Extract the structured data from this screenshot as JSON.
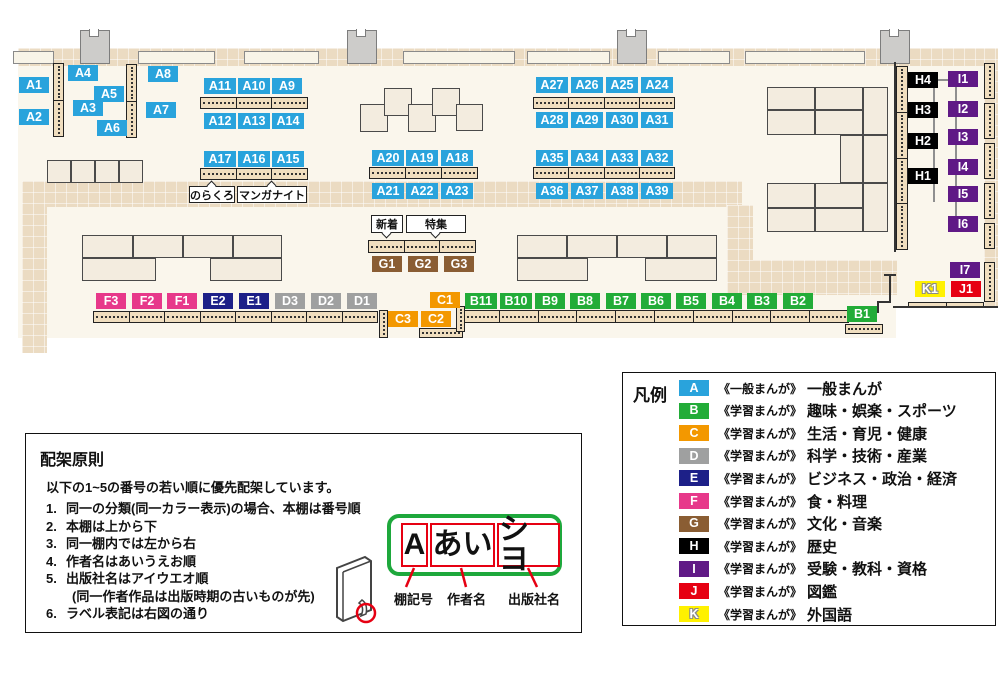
{
  "colors": {
    "A": "#29A3DC",
    "B": "#22AC38",
    "C": "#F39800",
    "D": "#9FA0A0",
    "E": "#1D2088",
    "F": "#E7388A",
    "G": "#8A5D33",
    "H": "#000000",
    "I": "#601986",
    "J": "#E60012",
    "K": "#FFF100"
  },
  "map": {
    "labels": [
      {
        "t": "A1",
        "c": "A",
        "x": 19,
        "y": 77
      },
      {
        "t": "A2",
        "c": "A",
        "x": 19,
        "y": 109
      },
      {
        "t": "A4",
        "c": "A",
        "x": 68,
        "y": 65
      },
      {
        "t": "A5",
        "c": "A",
        "x": 94,
        "y": 86
      },
      {
        "t": "A3",
        "c": "A",
        "x": 73,
        "y": 100
      },
      {
        "t": "A6",
        "c": "A",
        "x": 97,
        "y": 120
      },
      {
        "t": "A8",
        "c": "A",
        "x": 148,
        "y": 66
      },
      {
        "t": "A7",
        "c": "A",
        "x": 146,
        "y": 102
      },
      {
        "t": "A11",
        "c": "A",
        "x": 204,
        "y": 78
      },
      {
        "t": "A10",
        "c": "A",
        "x": 238,
        "y": 78
      },
      {
        "t": "A9",
        "c": "A",
        "x": 272,
        "y": 78
      },
      {
        "t": "A12",
        "c": "A",
        "x": 204,
        "y": 113
      },
      {
        "t": "A13",
        "c": "A",
        "x": 238,
        "y": 113
      },
      {
        "t": "A14",
        "c": "A",
        "x": 272,
        "y": 113
      },
      {
        "t": "A17",
        "c": "A",
        "x": 204,
        "y": 151
      },
      {
        "t": "A16",
        "c": "A",
        "x": 238,
        "y": 151
      },
      {
        "t": "A15",
        "c": "A",
        "x": 272,
        "y": 151
      },
      {
        "t": "A20",
        "c": "A",
        "x": 372,
        "y": 150
      },
      {
        "t": "A19",
        "c": "A",
        "x": 406,
        "y": 150
      },
      {
        "t": "A18",
        "c": "A",
        "x": 441,
        "y": 150
      },
      {
        "t": "A21",
        "c": "A",
        "x": 372,
        "y": 183
      },
      {
        "t": "A22",
        "c": "A",
        "x": 406,
        "y": 183
      },
      {
        "t": "A23",
        "c": "A",
        "x": 441,
        "y": 183
      },
      {
        "t": "A27",
        "c": "A",
        "x": 536,
        "y": 77
      },
      {
        "t": "A26",
        "c": "A",
        "x": 571,
        "y": 77
      },
      {
        "t": "A25",
        "c": "A",
        "x": 606,
        "y": 77
      },
      {
        "t": "A24",
        "c": "A",
        "x": 641,
        "y": 77
      },
      {
        "t": "A28",
        "c": "A",
        "x": 536,
        "y": 112
      },
      {
        "t": "A29",
        "c": "A",
        "x": 571,
        "y": 112
      },
      {
        "t": "A30",
        "c": "A",
        "x": 606,
        "y": 112
      },
      {
        "t": "A31",
        "c": "A",
        "x": 641,
        "y": 112
      },
      {
        "t": "A35",
        "c": "A",
        "x": 536,
        "y": 150
      },
      {
        "t": "A34",
        "c": "A",
        "x": 571,
        "y": 150
      },
      {
        "t": "A33",
        "c": "A",
        "x": 606,
        "y": 150
      },
      {
        "t": "A32",
        "c": "A",
        "x": 641,
        "y": 150
      },
      {
        "t": "A36",
        "c": "A",
        "x": 536,
        "y": 183
      },
      {
        "t": "A37",
        "c": "A",
        "x": 571,
        "y": 183
      },
      {
        "t": "A38",
        "c": "A",
        "x": 606,
        "y": 183
      },
      {
        "t": "A39",
        "c": "A",
        "x": 641,
        "y": 183
      },
      {
        "t": "G1",
        "c": "G",
        "x": 372,
        "y": 256
      },
      {
        "t": "G2",
        "c": "G",
        "x": 408,
        "y": 256
      },
      {
        "t": "G3",
        "c": "G",
        "x": 444,
        "y": 256
      },
      {
        "t": "F3",
        "c": "F",
        "x": 96,
        "y": 293
      },
      {
        "t": "F2",
        "c": "F",
        "x": 132,
        "y": 293
      },
      {
        "t": "F1",
        "c": "F",
        "x": 167,
        "y": 293
      },
      {
        "t": "E2",
        "c": "E",
        "x": 203,
        "y": 293
      },
      {
        "t": "E1",
        "c": "E",
        "x": 239,
        "y": 293
      },
      {
        "t": "D3",
        "c": "D",
        "x": 275,
        "y": 293
      },
      {
        "t": "D2",
        "c": "D",
        "x": 311,
        "y": 293
      },
      {
        "t": "D1",
        "c": "D",
        "x": 347,
        "y": 293
      },
      {
        "t": "C1",
        "c": "C",
        "x": 430,
        "y": 292
      },
      {
        "t": "C3",
        "c": "C",
        "x": 388,
        "y": 311
      },
      {
        "t": "C2",
        "c": "C",
        "x": 421,
        "y": 311
      },
      {
        "t": "B11",
        "c": "B",
        "x": 465,
        "y": 293
      },
      {
        "t": "B10",
        "c": "B",
        "x": 500,
        "y": 293
      },
      {
        "t": "B9",
        "c": "B",
        "x": 535,
        "y": 293
      },
      {
        "t": "B8",
        "c": "B",
        "x": 570,
        "y": 293
      },
      {
        "t": "B7",
        "c": "B",
        "x": 606,
        "y": 293
      },
      {
        "t": "B6",
        "c": "B",
        "x": 641,
        "y": 293
      },
      {
        "t": "B5",
        "c": "B",
        "x": 676,
        "y": 293
      },
      {
        "t": "B4",
        "c": "B",
        "x": 712,
        "y": 293
      },
      {
        "t": "B3",
        "c": "B",
        "x": 747,
        "y": 293
      },
      {
        "t": "B2",
        "c": "B",
        "x": 783,
        "y": 293
      },
      {
        "t": "B1",
        "c": "B",
        "x": 847,
        "y": 306
      },
      {
        "t": "H4",
        "c": "H",
        "x": 908,
        "y": 72
      },
      {
        "t": "H3",
        "c": "H",
        "x": 908,
        "y": 102
      },
      {
        "t": "H2",
        "c": "H",
        "x": 908,
        "y": 133
      },
      {
        "t": "H1",
        "c": "H",
        "x": 908,
        "y": 168
      },
      {
        "t": "I1",
        "c": "I",
        "x": 948,
        "y": 71
      },
      {
        "t": "I2",
        "c": "I",
        "x": 948,
        "y": 101
      },
      {
        "t": "I3",
        "c": "I",
        "x": 948,
        "y": 129
      },
      {
        "t": "I4",
        "c": "I",
        "x": 948,
        "y": 159
      },
      {
        "t": "I5",
        "c": "I",
        "x": 948,
        "y": 186
      },
      {
        "t": "I6",
        "c": "I",
        "x": 948,
        "y": 216
      },
      {
        "t": "I7",
        "c": "I",
        "x": 950,
        "y": 262
      },
      {
        "t": "K1",
        "c": "K",
        "x": 915,
        "y": 281
      },
      {
        "t": "J1",
        "c": "J",
        "x": 951,
        "y": 281
      }
    ],
    "notes": [
      {
        "t": "のらくろ",
        "x": 189,
        "y": 186,
        "w": 46,
        "h": 17,
        "tail": "top"
      },
      {
        "t": "マンガナイト",
        "x": 237,
        "y": 186,
        "w": 70,
        "h": 17,
        "tail": "top"
      },
      {
        "t": "新着",
        "x": 371,
        "y": 215,
        "w": 32,
        "h": 18,
        "tail": "bottom"
      },
      {
        "t": "特集",
        "x": 406,
        "y": 215,
        "w": 60,
        "h": 18,
        "tail": "bottom"
      }
    ],
    "strips": [
      {
        "x": 200,
        "y": 97,
        "w": 108,
        "h": 12,
        "s": 3
      },
      {
        "x": 200,
        "y": 168,
        "w": 108,
        "h": 12,
        "s": 3
      },
      {
        "x": 369,
        "y": 167,
        "w": 109,
        "h": 12,
        "s": 3
      },
      {
        "x": 533,
        "y": 97,
        "w": 142,
        "h": 12,
        "s": 4
      },
      {
        "x": 533,
        "y": 167,
        "w": 142,
        "h": 12,
        "s": 4
      },
      {
        "x": 368,
        "y": 240,
        "w": 108,
        "h": 13,
        "s": 3
      },
      {
        "x": 93,
        "y": 311,
        "w": 285,
        "h": 12,
        "s": 8
      },
      {
        "x": 460,
        "y": 310,
        "w": 389,
        "h": 13,
        "s": 10
      },
      {
        "x": 419,
        "y": 328,
        "w": 44,
        "h": 10,
        "s": 1
      },
      {
        "x": 845,
        "y": 324,
        "w": 38,
        "h": 10,
        "s": 1
      },
      {
        "x": 908,
        "y": 302,
        "w": 76,
        "h": 11,
        "s": 2
      },
      {
        "x": 53,
        "y": 63,
        "w": 11,
        "h": 74,
        "s": 2,
        "v": 1
      },
      {
        "x": 126,
        "y": 64,
        "w": 11,
        "h": 74,
        "s": 2,
        "v": 1
      },
      {
        "x": 896,
        "y": 66,
        "w": 12,
        "h": 184,
        "s": 4,
        "v": 1
      },
      {
        "x": 984,
        "y": 63,
        "w": 11,
        "h": 36,
        "s": 1,
        "v": 1
      },
      {
        "x": 984,
        "y": 103,
        "w": 11,
        "h": 36,
        "s": 1,
        "v": 1
      },
      {
        "x": 984,
        "y": 143,
        "w": 11,
        "h": 36,
        "s": 1,
        "v": 1
      },
      {
        "x": 984,
        "y": 183,
        "w": 11,
        "h": 36,
        "s": 1,
        "v": 1
      },
      {
        "x": 984,
        "y": 223,
        "w": 11,
        "h": 26,
        "s": 1,
        "v": 1
      },
      {
        "x": 984,
        "y": 262,
        "w": 11,
        "h": 40,
        "s": 1,
        "v": 1
      },
      {
        "x": 379,
        "y": 310,
        "w": 9,
        "h": 28,
        "s": 1,
        "v": 1
      },
      {
        "x": 456,
        "y": 306,
        "w": 9,
        "h": 26,
        "s": 1,
        "v": 1
      }
    ],
    "tables": [
      {
        "x": 47,
        "y": 160,
        "w": 24,
        "h": 23
      },
      {
        "x": 71,
        "y": 160,
        "w": 24,
        "h": 23
      },
      {
        "x": 95,
        "y": 160,
        "w": 24,
        "h": 23
      },
      {
        "x": 119,
        "y": 160,
        "w": 24,
        "h": 23
      },
      {
        "x": 360,
        "y": 104,
        "w": 28,
        "h": 28
      },
      {
        "x": 384,
        "y": 88,
        "w": 28,
        "h": 28
      },
      {
        "x": 408,
        "y": 104,
        "w": 28,
        "h": 28
      },
      {
        "x": 432,
        "y": 88,
        "w": 28,
        "h": 28
      },
      {
        "x": 456,
        "y": 104,
        "w": 27,
        "h": 27
      },
      {
        "x": 82,
        "y": 235,
        "w": 51,
        "h": 23
      },
      {
        "x": 133,
        "y": 235,
        "w": 50,
        "h": 23
      },
      {
        "x": 183,
        "y": 235,
        "w": 50,
        "h": 23
      },
      {
        "x": 233,
        "y": 235,
        "w": 49,
        "h": 23
      },
      {
        "x": 82,
        "y": 258,
        "w": 74,
        "h": 23
      },
      {
        "x": 210,
        "y": 258,
        "w": 72,
        "h": 23
      },
      {
        "x": 517,
        "y": 235,
        "w": 50,
        "h": 23
      },
      {
        "x": 567,
        "y": 235,
        "w": 50,
        "h": 23
      },
      {
        "x": 617,
        "y": 235,
        "w": 50,
        "h": 23
      },
      {
        "x": 667,
        "y": 235,
        "w": 50,
        "h": 23
      },
      {
        "x": 517,
        "y": 258,
        "w": 71,
        "h": 23
      },
      {
        "x": 645,
        "y": 258,
        "w": 72,
        "h": 23
      },
      {
        "x": 767,
        "y": 87,
        "w": 48,
        "h": 23
      },
      {
        "x": 815,
        "y": 87,
        "w": 48,
        "h": 23
      },
      {
        "x": 863,
        "y": 87,
        "w": 25,
        "h": 48
      },
      {
        "x": 767,
        "y": 110,
        "w": 48,
        "h": 25
      },
      {
        "x": 815,
        "y": 110,
        "w": 48,
        "h": 25
      },
      {
        "x": 840,
        "y": 135,
        "w": 23,
        "h": 48
      },
      {
        "x": 863,
        "y": 135,
        "w": 25,
        "h": 48
      },
      {
        "x": 767,
        "y": 183,
        "w": 48,
        "h": 25
      },
      {
        "x": 815,
        "y": 183,
        "w": 48,
        "h": 25
      },
      {
        "x": 863,
        "y": 183,
        "w": 25,
        "h": 49
      },
      {
        "x": 767,
        "y": 208,
        "w": 48,
        "h": 24
      },
      {
        "x": 815,
        "y": 208,
        "w": 48,
        "h": 24
      }
    ],
    "walkways": [
      {
        "x": 18,
        "y": 48,
        "w": 980,
        "h": 18
      },
      {
        "x": 22,
        "y": 181,
        "w": 720,
        "h": 26
      },
      {
        "x": 22,
        "y": 181,
        "w": 25,
        "h": 172
      },
      {
        "x": 727,
        "y": 205,
        "w": 26,
        "h": 78
      },
      {
        "x": 727,
        "y": 260,
        "w": 170,
        "h": 35
      },
      {
        "x": 984,
        "y": 48,
        "w": 14,
        "h": 260
      }
    ],
    "windows": [
      {
        "x": 13,
        "w": 41
      },
      {
        "x": 138,
        "w": 77
      },
      {
        "x": 244,
        "w": 75
      },
      {
        "x": 403,
        "w": 112
      },
      {
        "x": 527,
        "w": 83
      },
      {
        "x": 658,
        "w": 72
      },
      {
        "x": 745,
        "w": 120
      }
    ],
    "pillars": [
      {
        "x": 80
      },
      {
        "x": 347
      },
      {
        "x": 617
      },
      {
        "x": 880
      }
    ],
    "walls": [
      {
        "x": 894,
        "y": 62,
        "w": 2,
        "h": 190
      },
      {
        "x": 884,
        "y": 274,
        "w": 12,
        "h": 2
      },
      {
        "x": 889,
        "y": 274,
        "w": 2,
        "h": 29
      },
      {
        "x": 877,
        "y": 301,
        "w": 14,
        "h": 2
      },
      {
        "x": 877,
        "y": 301,
        "w": 2,
        "h": 12
      },
      {
        "x": 893,
        "y": 306,
        "w": 105,
        "h": 2
      }
    ],
    "connectors": [
      {
        "x": 933,
        "y": 80,
        "w": 2,
        "h": 122
      },
      {
        "x": 955,
        "y": 80,
        "w": 2,
        "h": 152
      },
      {
        "x": 938,
        "y": 79,
        "w": 17,
        "h": 2
      }
    ]
  },
  "legend": {
    "title": "凡例",
    "rows": [
      {
        "letter": "A",
        "c": "A",
        "qualifier": "《一般まんが》",
        "category": "一般まんが"
      },
      {
        "letter": "B",
        "c": "B",
        "qualifier": "《学習まんが》",
        "category": "趣味・娯楽・スポーツ"
      },
      {
        "letter": "C",
        "c": "C",
        "qualifier": "《学習まんが》",
        "category": "生活・育児・健康"
      },
      {
        "letter": "D",
        "c": "D",
        "qualifier": "《学習まんが》",
        "category": "科学・技術・産業"
      },
      {
        "letter": "E",
        "c": "E",
        "qualifier": "《学習まんが》",
        "category": "ビジネス・政治・経済"
      },
      {
        "letter": "F",
        "c": "F",
        "qualifier": "《学習まんが》",
        "category": "食・料理"
      },
      {
        "letter": "G",
        "c": "G",
        "qualifier": "《学習まんが》",
        "category": "文化・音楽"
      },
      {
        "letter": "H",
        "c": "H",
        "qualifier": "《学習まんが》",
        "category": "歴史"
      },
      {
        "letter": "I",
        "c": "I",
        "qualifier": "《学習まんが》",
        "category": "受験・教科・資格"
      },
      {
        "letter": "J",
        "c": "J",
        "qualifier": "《学習まんが》",
        "category": "図鑑"
      },
      {
        "letter": "K",
        "c": "K",
        "qualifier": "《学習まんが》",
        "category": "外国語"
      }
    ]
  },
  "principles": {
    "title": "配架原則",
    "intro": "以下の1~5の番号の若い順に優先配架しています。",
    "items": [
      {
        "no": "1.",
        "text": "同一の分類(同一カラー表示)の場合、本棚は番号順"
      },
      {
        "no": "2.",
        "text": "本棚は上から下"
      },
      {
        "no": "3.",
        "text": "同一棚内では左から右"
      },
      {
        "no": "4.",
        "text": "作者名はあいうえお順"
      },
      {
        "no": "5.",
        "text": "出版社名はアイウエオ順"
      },
      {
        "no": "",
        "text": "(同一作者作品は出版時期の古いものが先)"
      },
      {
        "no": "6.",
        "text": "ラベル表記は右図の通り"
      }
    ]
  },
  "label_diagram": {
    "shelf_code": "A",
    "author": "あい",
    "publisher": "シヨ",
    "captions": [
      "棚記号",
      "作者名",
      "出版社名"
    ]
  }
}
